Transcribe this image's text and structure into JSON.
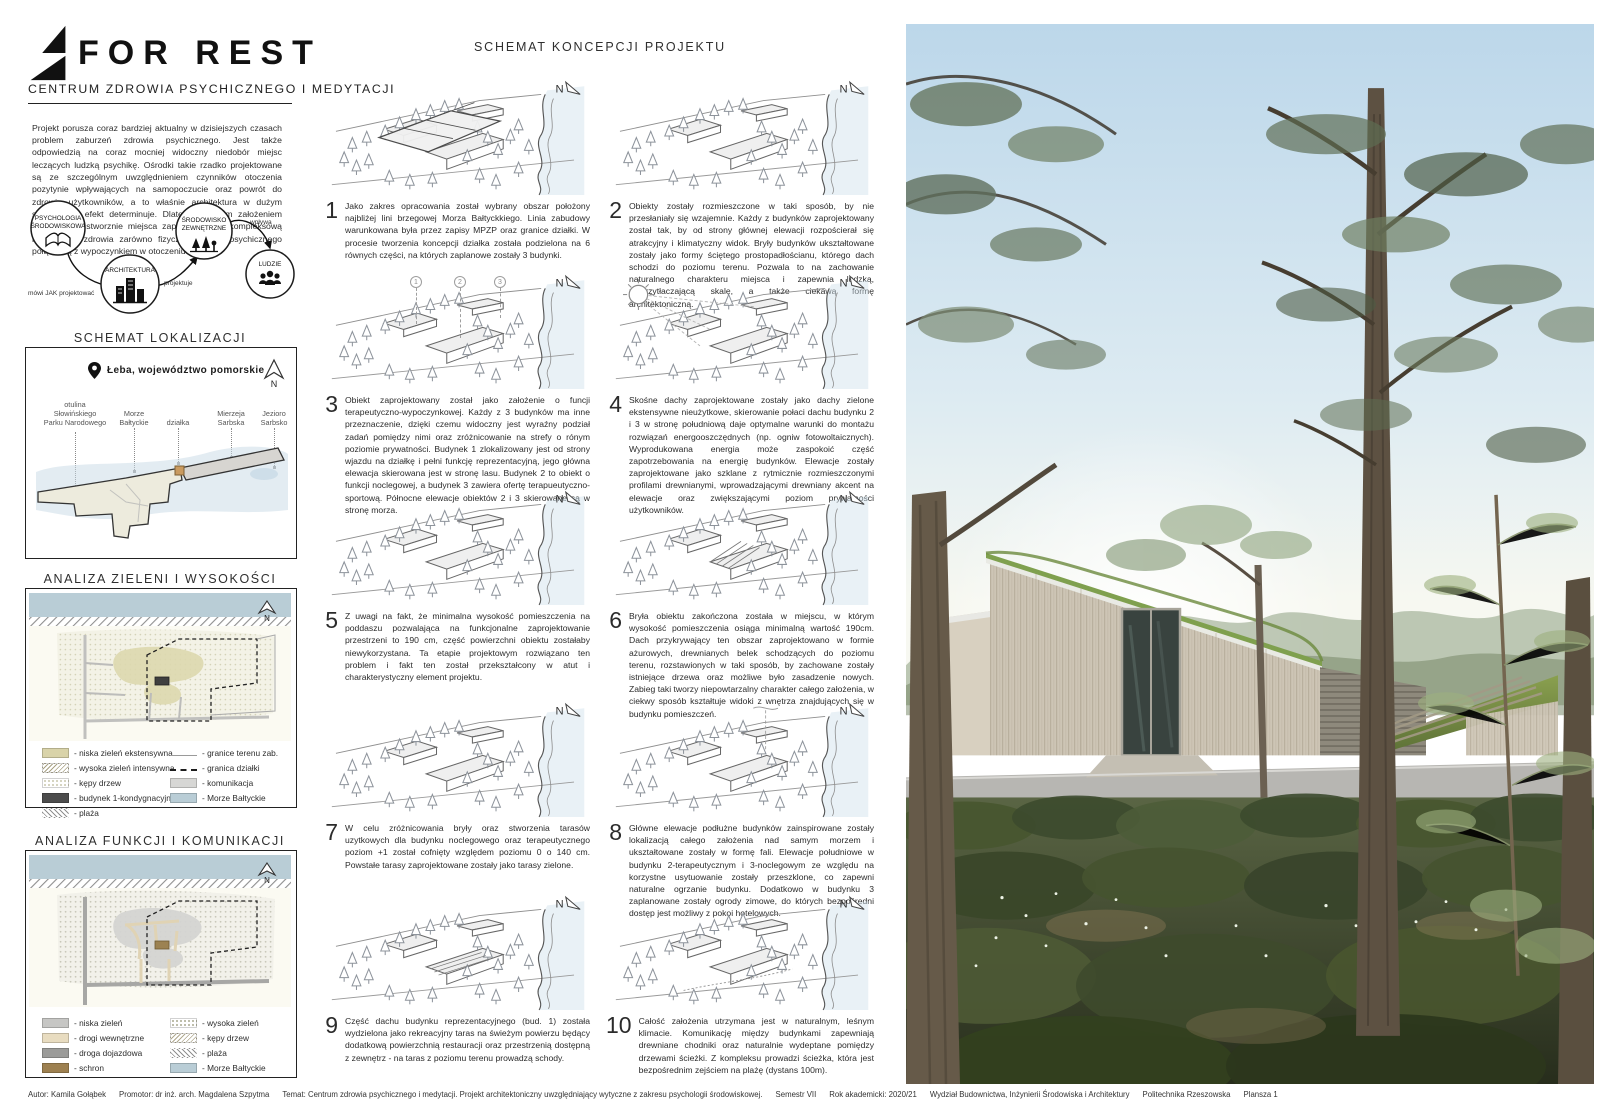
{
  "header": {
    "logo": "FOR REST",
    "subtitle": "CENTRUM ZDROWIA PSYCHICZNEGO I MEDYTACJI"
  },
  "intro": "Projekt porusza coraz bardziej aktualny w dzisiejszych czasach problem zaburzeń zdrowia psychicznego. Jest także odpowiedzią na coraz mocniej widoczny niedobór miejsc leczących ludzką psychikę. Ośrodki takie rzadko projektowane są ze szczególnym uwzględnieniem czynników otoczenia pozytynie wpływających na samopoczucie oraz powrót do zdrowia użytkowników, a to właśnie architektura w dużym stopniu taki efekt determinuje. Dlatego głównym założeniem projektu jest stworznie miejsca zapewniającego kompleksową regenerację zdrowia zarówno fizycznego jak i psychicznego połączoną z wypoczynkiem w otoczeniu natury.",
  "north_label": "N",
  "concept_flow": {
    "nodes": [
      {
        "line1": "PSYCHOLOGIA",
        "line2": "ŚRODOWISKOWA"
      },
      {
        "line1": "ARCHITEKTURA",
        "line2": ""
      },
      {
        "line1": "ŚRODOWISKO",
        "line2": "ZEWNĘTRZNE"
      },
      {
        "line1": "LUDZIE",
        "line2": ""
      }
    ],
    "edge1": "mówi JAK projektować",
    "edge2": "projektuje",
    "edge3": "wpływa"
  },
  "location_map": {
    "title": "SCHEMAT LOKALIZACJI",
    "place": "Łeba, województwo pomorskie",
    "labels": [
      "otulina\nSłowińskiego\nParku Narodowego",
      "Morze\nBałtyckie",
      "działka",
      "Mierzeja\nSarbska",
      "Jezioro\nSarbsko"
    ]
  },
  "greenery_analysis": {
    "title": "ANALIZA ZIELENI I WYSOKOŚCI  1:5000",
    "legend_left": [
      {
        "label": "- niska zieleń ekstensywna",
        "type": "fill",
        "color": "#d9d3a9"
      },
      {
        "label": "- wysoka zieleń intensywna",
        "type": "waves",
        "color": "#a9a284"
      },
      {
        "label": "- kępy drzew",
        "type": "dots",
        "color": "#cfcdb6"
      },
      {
        "label": "- budynek 1-kondygnacyjny",
        "type": "fill",
        "color": "#4c4c4c"
      },
      {
        "label": "- plaża",
        "type": "hatch",
        "color": "#8f8f8f"
      }
    ],
    "legend_right": [
      {
        "label": "- granice terenu zab.",
        "type": "line",
        "color": "#9a9a9a"
      },
      {
        "label": "- granica działki",
        "type": "dash",
        "color": "#1d1d1d"
      },
      {
        "label": "- komunikacja",
        "type": "fill",
        "color": "#d7d7d5"
      },
      {
        "label": "- Morze Bałtyckie",
        "type": "fill",
        "color": "#b9cdd6"
      }
    ]
  },
  "functions_analysis": {
    "title": "ANALIZA FUNKCJI I KOMUNIKACJI 1:5000",
    "legend_left": [
      {
        "label": "- niska zieleń",
        "type": "fill",
        "color": "#c6c6c4"
      },
      {
        "label": "- drogi wewnętrzne",
        "type": "fill",
        "color": "#e8dcc0"
      },
      {
        "label": "- droga dojazdowa",
        "type": "fill",
        "color": "#9b9b99"
      },
      {
        "label": "- schron",
        "type": "fill",
        "color": "#9d8050"
      }
    ],
    "legend_right": [
      {
        "label": "- wysoka zieleń",
        "type": "dots",
        "color": "#b3b39c"
      },
      {
        "label": "- kępy drzew",
        "type": "waves",
        "color": "#b0a98e"
      },
      {
        "label": "- plaża",
        "type": "hatch",
        "color": "#8f8f8f"
      },
      {
        "label": "- Morze Bałtyckie",
        "type": "fill",
        "color": "#b9cdd6"
      }
    ]
  },
  "concept_schema": {
    "title": "SCHEMAT KONCEPCJI PROJEKTU",
    "markers": [
      "1",
      "2",
      "3"
    ],
    "items": [
      {
        "num": "1",
        "text": "Jako zakres opracowania został wybrany obszar położony najbliżej lini brzegowej Morza Bałtyckkiego. Linia zabudowy warunkowana była przez zapisy MPZP oraz granice działki. W procesie tworzenia koncepcji działka została podzielona na 6 równych części, na których zaplanowe zostały 3 budynki."
      },
      {
        "num": "2",
        "text": "Obiekty zostały rozmieszczone w taki sposób, by nie przesłaniały się wzajemnie. Każdy z budynków zaprojektowany został tak, by od strony głównej elewacji rozpościerał się atrakcyjny i klimatyczny widok. Bryły budynków ukształtowane zostały jako formy ściętego prostopadłościanu, którego dach schodzi do poziomu terenu. Pozwala to na zachowanie naturalnego charakteru miejsca i zapewnia ludzką, nieprzytłaczającą skalę, a także ciekawą formę architektoniczną."
      },
      {
        "num": "3",
        "text": "Obiekt zaprojektowany został jako założenie o funcji terapeutyczno-wypoczynkowej. Każdy z 3 budynków ma inne przeznaczenie, dzięki czemu widoczny jest wyraźny podział zadań pomiędzy nimi oraz zróżnicowanie na strefy o rónym poziomie prywatności. Budynek 1 zlokalizowany jest od strony wjazdu na działkę i pełni funkcję reprezentacyjną, jego główna elewacja skierowana jest w stronę lasu. Budynek 2 to obiekt o funkcji noclegowej, a budynek 3 zawiera ofertę terapueutyczno-sportową. Północne elewacje obiektów 2 i 3 skierowane są w stronę morza."
      },
      {
        "num": "4",
        "text": "Skośne dachy zaprojektowane zostały jako dachy zielone ekstensywne nieużytkowe, skierowanie połaci dachu budynku 2 i 3 w stronę południową daje optymalne warunki do montażu rozwiązań energooszczędnych (np. ogniw fotowoltaicznych). Wyprodukowana energia może zaspokoić część zapotrzebowania na energię budynków. Elewacje zostały zaprojektowane jako szklane z rytmicznie rozmieszczonymi profilami drewnianymi, wprowadzającymi drewniany akcent na elewacje oraz zwiększającymi poziom prywatności użytkowników."
      },
      {
        "num": "5",
        "text": "Z uwagi na fakt, że minimalna wysokość pomieszczenia na poddaszu pozwalająca na funkcjonalne zaprojektowanie przestrzeni to 190 cm, część powierzchni obiektu zostałaby niewykorzystana. Ta etapie projektowym rozwiązano ten problem i fakt ten został przekształcony w atut i charakterystyczny element projektu."
      },
      {
        "num": "6",
        "text": "Bryła obiektu zakończona została w miejscu, w którym wysokość pomieszczenia osiąga minimalną wartość 190cm. Dach przykrywający ten obszar zaprojektowano w formie ażurowych, drewnianych belek schodzących do poziomu terenu, rozstawionych w taki sposób, by zachowane zostały istniejące drzewa oraz możliwe było zasadzenie nowych. Zabieg taki tworzy niepowtarzalny charakter całego założenia, w ciekwy sposób kształtuje widoki z wnętrza znajdujących się w budynku pomieszczeń."
      },
      {
        "num": "7",
        "text": "W celu zróżnicowania bryły oraz stworzenia tarasów uzytkowych dla budynku noclegowego oraz terapeutycznego poziom +1 został cofnięty względem poziomu 0 o 140 cm. Powstałe tarasy zaprojektowane zostały jako tarasy zielone."
      },
      {
        "num": "8",
        "text": "Główne elewacje podłużne budynków zainspirowane zostały lokalizacją całego założenia nad samym morzem i ukształtowane zostały w formę fali. Elewacje południowe w budynku 2-terapeutycznym i 3-noclegowym ze względu na korzystne usytuowanie zostały przeszklone, co zapewni naturalne ogrzanie budynku. Dodatkowo w budynku 3 zaplanowane zostały ogrody zimowe, do których bezpośredni dostęp jest możliwy z pokoi hotelowych."
      },
      {
        "num": "9",
        "text": "Część dachu budynku reprezentacyjnego (bud. 1) została wydzielona jako rekreacyjny taras na świeżym powierzu będący dodatkową powierzchnią restauracji oraz przestrzenią dostępną z zewnętrz - na taras z poziomu terenu prowadzą schody."
      },
      {
        "num": "10",
        "text": "Całość założenia utrzymana jest w naturalnym, leśnym klimacie. Komunikację między budynkami zapewniają drewniane chodniki oraz naturalnie wydeptane pomiędzy drzewami ścieżki. Z kompleksu prowadzi ścieżka, która jest bezpośrednim zejściem na plażę (dystans 100m)."
      }
    ]
  },
  "footer": {
    "segments": [
      "Autor: Kamila Gołąbek",
      "Promotor: dr inż. arch. Magdalena Szpytma",
      "Temat: Centrum zdrowia psychicznego i medytacji. Projekt architektoniczny uwzględniający wytyczne z zakresu psychologii środowiskowej.",
      "Semestr VII",
      "Rok akademicki: 2020/21",
      "Wydział Budownictwa, Inżynierii Środowiska i Architektury",
      "Politechnika Rzeszowska",
      "Plansza 1"
    ]
  },
  "colors": {
    "sea": "#b9cdd6",
    "sand": "#d9d3a9",
    "sky": "#c9dfef",
    "foliage": "#5e6d52",
    "wood": "#cdc5b5",
    "grass_roof": "#7fa04e",
    "ink": "#222222"
  }
}
